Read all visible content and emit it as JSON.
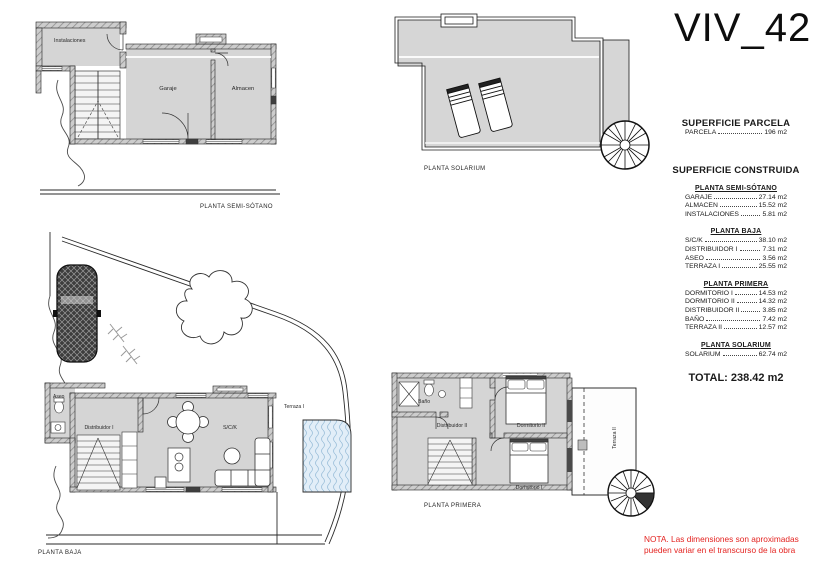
{
  "title": "VIV_42",
  "parcel": {
    "heading": "SUPERFICIE PARCELA",
    "row": {
      "label": "PARCELA",
      "value": "196 m2"
    }
  },
  "built": {
    "heading": "SUPERFICIE CONSTRUIDA",
    "sections": [
      {
        "heading": "PLANTA SEMI-SÓTANO",
        "rows": [
          {
            "label": "GARAJE",
            "value": "27.14 m2"
          },
          {
            "label": "ALMACEN",
            "value": "15.52 m2"
          },
          {
            "label": "INSTALACIONES",
            "value": "5.81 m2"
          }
        ]
      },
      {
        "heading": "PLANTA BAJA",
        "rows": [
          {
            "label": "S/C/K",
            "value": "38.10 m2"
          },
          {
            "label": "DISTRIBUIDOR I",
            "value": "7.31 m2"
          },
          {
            "label": "ASEO",
            "value": "3.56 m2"
          },
          {
            "label": "TERRAZA I",
            "value": "25.55 m2"
          }
        ]
      },
      {
        "heading": "PLANTA PRIMERA",
        "rows": [
          {
            "label": "DORMITORIO I",
            "value": "14.53 m2"
          },
          {
            "label": "DORMITORIO II",
            "value": "14.32 m2"
          },
          {
            "label": "DISTRIBUIDOR II",
            "value": "3.85 m2"
          },
          {
            "label": "BAÑO",
            "value": "7.42 m2"
          },
          {
            "label": "TERRAZA II",
            "value": "12.57 m2"
          }
        ]
      },
      {
        "heading": "PLANTA SOLARIUM",
        "rows": [
          {
            "label": "SOLARIUM",
            "value": "62.74 m2"
          }
        ]
      }
    ],
    "total": "TOTAL: 238.42 m2"
  },
  "plans": {
    "semisotano": {
      "caption": "PLANTA SEMI-SÓTANO",
      "labels": {
        "instalaciones": "Instalaciones",
        "garaje": "Garaje",
        "almacen": "Almacen"
      }
    },
    "solarium": {
      "caption": "PLANTA SOLARIUM"
    },
    "baja": {
      "caption": "PLANTA BAJA",
      "labels": {
        "aseo": "Aseo",
        "distribuidor": "Distribuidor I",
        "sck": "S/C/K",
        "terraza": "Terraza I"
      }
    },
    "primera": {
      "caption": "PLANTA PRIMERA",
      "labels": {
        "bano": "Baño",
        "distribuidor": "Distribuidor II",
        "dorm2": "Dormitorio II",
        "dorm1": "Dormitorio I",
        "terraza": "Terraza II"
      }
    }
  },
  "note": {
    "line1": "NOTA. Las dimensiones son aproximadas",
    "line2": "pueden variar en el transcurso de la obra"
  },
  "colors": {
    "room_fill": "#d5d5d5",
    "wall_hatch": "#8f8f8f",
    "outline": "#1b1b1b",
    "pool_fill": "#e2eef8",
    "pool_wave": "#9dc0da",
    "note_red": "#e42320"
  }
}
